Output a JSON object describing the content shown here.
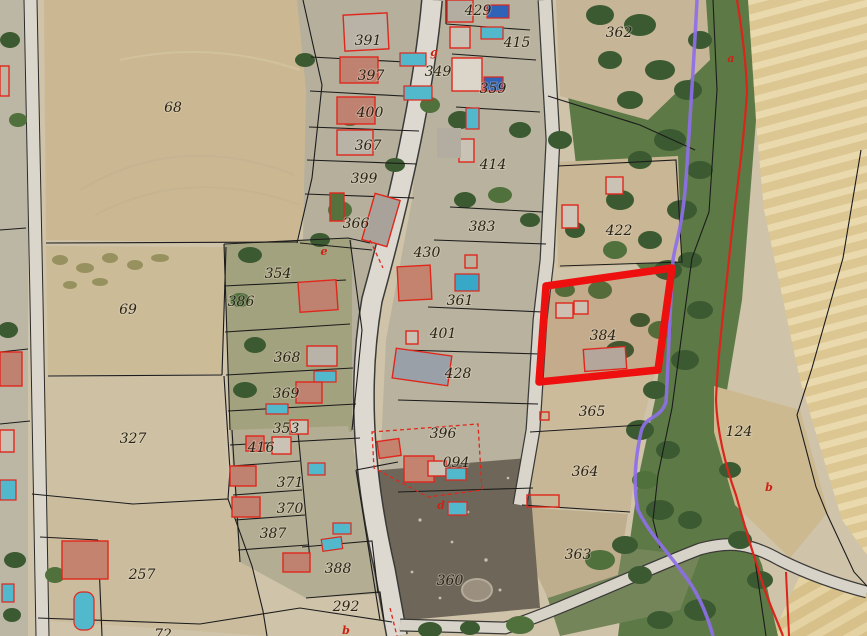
{
  "map": {
    "description": "Cadastral parcel overlay on aerial orthophoto",
    "selected_parcel": {
      "id": "384"
    },
    "colors": {
      "parcel_label": "#2a2318",
      "marker_letter": "#cc2214",
      "highlight": "#ee0f0f",
      "river": "#8d6fe8",
      "red_boundary": "#da241c",
      "parcel_line": "#1c1c1c",
      "building_outline": "#e0271c"
    },
    "parcel_labels": [
      {
        "id": "68",
        "x": 173,
        "y": 107
      },
      {
        "id": "69",
        "x": 128,
        "y": 309
      },
      {
        "id": "327",
        "x": 133,
        "y": 438
      },
      {
        "id": "257",
        "x": 142,
        "y": 574
      },
      {
        "id": "72",
        "x": 163,
        "y": 634
      },
      {
        "id": "391",
        "x": 368,
        "y": 40
      },
      {
        "id": "397",
        "x": 371,
        "y": 75
      },
      {
        "id": "400",
        "x": 370,
        "y": 112
      },
      {
        "id": "367",
        "x": 368,
        "y": 145
      },
      {
        "id": "399",
        "x": 364,
        "y": 178
      },
      {
        "id": "366",
        "x": 356,
        "y": 223
      },
      {
        "id": "354",
        "x": 278,
        "y": 273
      },
      {
        "id": "386",
        "x": 241,
        "y": 301
      },
      {
        "id": "368",
        "x": 287,
        "y": 357
      },
      {
        "id": "369",
        "x": 286,
        "y": 393
      },
      {
        "id": "353",
        "x": 286,
        "y": 428
      },
      {
        "id": "416",
        "x": 261,
        "y": 447
      },
      {
        "id": "371",
        "x": 290,
        "y": 482
      },
      {
        "id": "370",
        "x": 290,
        "y": 508
      },
      {
        "id": "387",
        "x": 273,
        "y": 533
      },
      {
        "id": "388",
        "x": 338,
        "y": 568
      },
      {
        "id": "292",
        "x": 346,
        "y": 606
      },
      {
        "id": "429",
        "x": 478,
        "y": 10
      },
      {
        "id": "415",
        "x": 517,
        "y": 42
      },
      {
        "id": "349",
        "x": 438,
        "y": 71
      },
      {
        "id": "359",
        "x": 493,
        "y": 88
      },
      {
        "id": "414",
        "x": 493,
        "y": 164
      },
      {
        "id": "383",
        "x": 482,
        "y": 226
      },
      {
        "id": "430",
        "x": 427,
        "y": 252
      },
      {
        "id": "361",
        "x": 460,
        "y": 300
      },
      {
        "id": "401",
        "x": 443,
        "y": 333
      },
      {
        "id": "428",
        "x": 458,
        "y": 373
      },
      {
        "id": "396",
        "x": 443,
        "y": 433
      },
      {
        "id": "094",
        "x": 456,
        "y": 462
      },
      {
        "id": "360",
        "x": 450,
        "y": 580
      },
      {
        "id": "362",
        "x": 619,
        "y": 32
      },
      {
        "id": "422",
        "x": 619,
        "y": 230
      },
      {
        "id": "384",
        "x": 603,
        "y": 335
      },
      {
        "id": "365",
        "x": 592,
        "y": 411
      },
      {
        "id": "364",
        "x": 585,
        "y": 471
      },
      {
        "id": "363",
        "x": 578,
        "y": 554
      },
      {
        "id": "124",
        "x": 739,
        "y": 431
      }
    ],
    "marker_letters": [
      {
        "ch": "g",
        "x": 434,
        "y": 52
      },
      {
        "ch": "a",
        "x": 731,
        "y": 58
      },
      {
        "ch": "e",
        "x": 324,
        "y": 251
      },
      {
        "ch": "d",
        "x": 441,
        "y": 505
      },
      {
        "ch": "b",
        "x": 346,
        "y": 630
      },
      {
        "ch": "b",
        "x": 769,
        "y": 487
      }
    ]
  }
}
